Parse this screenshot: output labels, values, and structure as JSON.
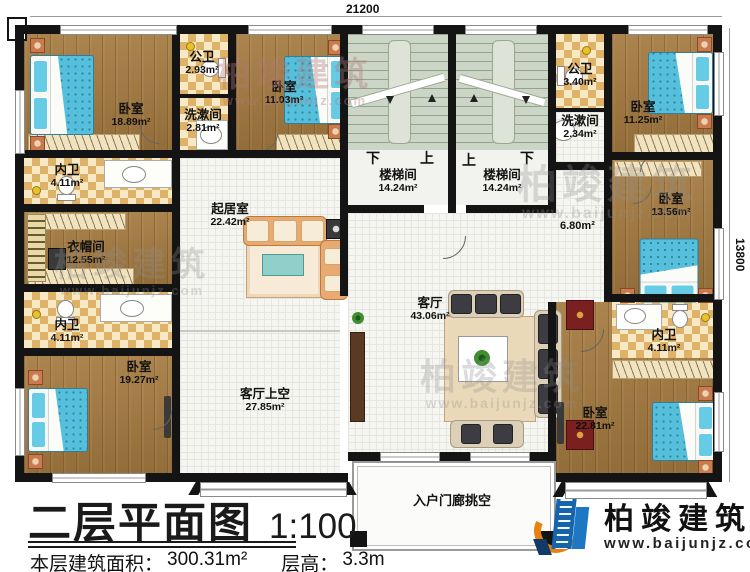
{
  "title_block": {
    "plan_title": "二层平面图",
    "scale": "1:100",
    "area_label": "本层建筑面积：",
    "area_value": "300.31m²",
    "floor_height_label": "层高：",
    "floor_height_value": "3.3m"
  },
  "dimensions": {
    "top_width": "21200",
    "right_height": "13800"
  },
  "rooms": {
    "bedroom_tl": {
      "name": "卧室",
      "area": "18.89m²"
    },
    "public_bath_top": {
      "name": "公卫",
      "area": "2.93m²"
    },
    "washroom_top": {
      "name": "洗漱间",
      "area": "2.81m²"
    },
    "bedroom_top_mid": {
      "name": "卧室",
      "area": "11.03m²"
    },
    "stairwell_left": {
      "name": "楼梯间",
      "area": "14.24m²"
    },
    "stairwell_right": {
      "name": "楼梯间",
      "area": "14.24m²"
    },
    "public_bath_right": {
      "name": "公卫",
      "area": "3.40m²"
    },
    "washroom_right": {
      "name": "洗漱间",
      "area": "2.34m²"
    },
    "bedroom_tr": {
      "name": "卧室",
      "area": "11.25m²"
    },
    "bedroom_right_mid": {
      "name": "卧室",
      "area": "13.56m²"
    },
    "inner_bath_right": {
      "name": "内卫",
      "area": "4.11m²"
    },
    "bedroom_br": {
      "name": "卧室",
      "area": "22.81m²"
    },
    "inner_bath_left_upper": {
      "name": "内卫",
      "area": "4.11m²"
    },
    "cloakroom": {
      "name": "衣帽间",
      "area": "12.55m²"
    },
    "inner_bath_left_lower": {
      "name": "内卫",
      "area": "4.11m²"
    },
    "bedroom_bl": {
      "name": "卧室",
      "area": "19.27m²"
    },
    "living_upper": {
      "name": "起居室",
      "area": "22.42m²"
    },
    "living_void": {
      "name": "客厅上空",
      "area": "27.85m²"
    },
    "living_room": {
      "name": "客厅",
      "area": "43.06m²"
    },
    "corridor": {
      "area": "6.80m²"
    },
    "entry_porch": {
      "name": "入户门廊挑空"
    }
  },
  "stair_labels": {
    "down": "下",
    "up": "上"
  },
  "watermark": {
    "brand": "柏竣建筑",
    "url": "www.baijunjz.com"
  },
  "logo": {
    "brand": "柏竣建筑",
    "url": "www.baijunjz.com"
  }
}
